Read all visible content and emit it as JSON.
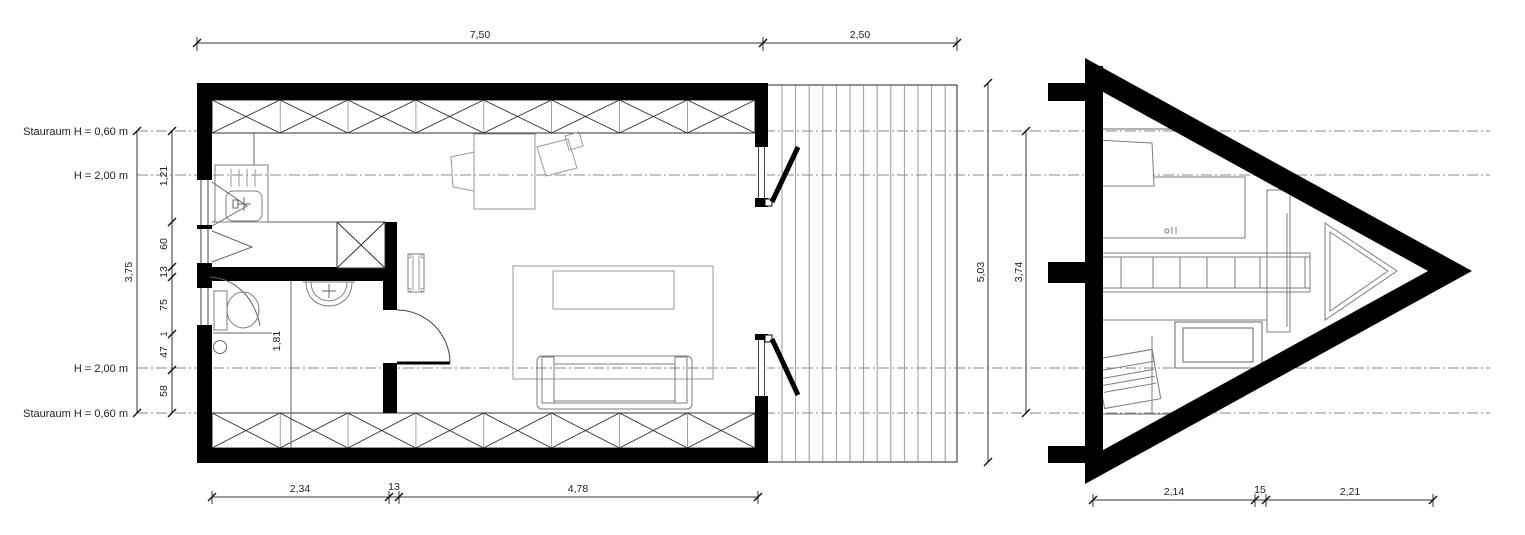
{
  "colors": {
    "wall": "#000000",
    "structure_line": "#444444",
    "furniture_line": "#999999",
    "centerline": "#8a8a8a",
    "background": "#ffffff"
  },
  "annotations": {
    "stauraum_top": "Stauraum H = 0,60 m",
    "height_top": "H = 2,00 m",
    "height_bottom": "H = 2,00 m",
    "stauraum_bottom": "Stauraum H = 0,60 m",
    "bath_width": "1,81"
  },
  "dimensions": {
    "top": {
      "plan": "7,50",
      "deck": "2,50"
    },
    "bottom": {
      "seg1": "2,34",
      "seg2": "13",
      "seg3": "4,78"
    },
    "left": {
      "overall": "3,75",
      "chain": [
        "1,21",
        "60",
        "13",
        "75",
        "1",
        "47",
        "58"
      ]
    },
    "right": {
      "overall": "5,03",
      "inner": "3,74"
    },
    "aframe": {
      "seg1": "2,14",
      "seg2": "15",
      "seg3": "2,21"
    }
  }
}
